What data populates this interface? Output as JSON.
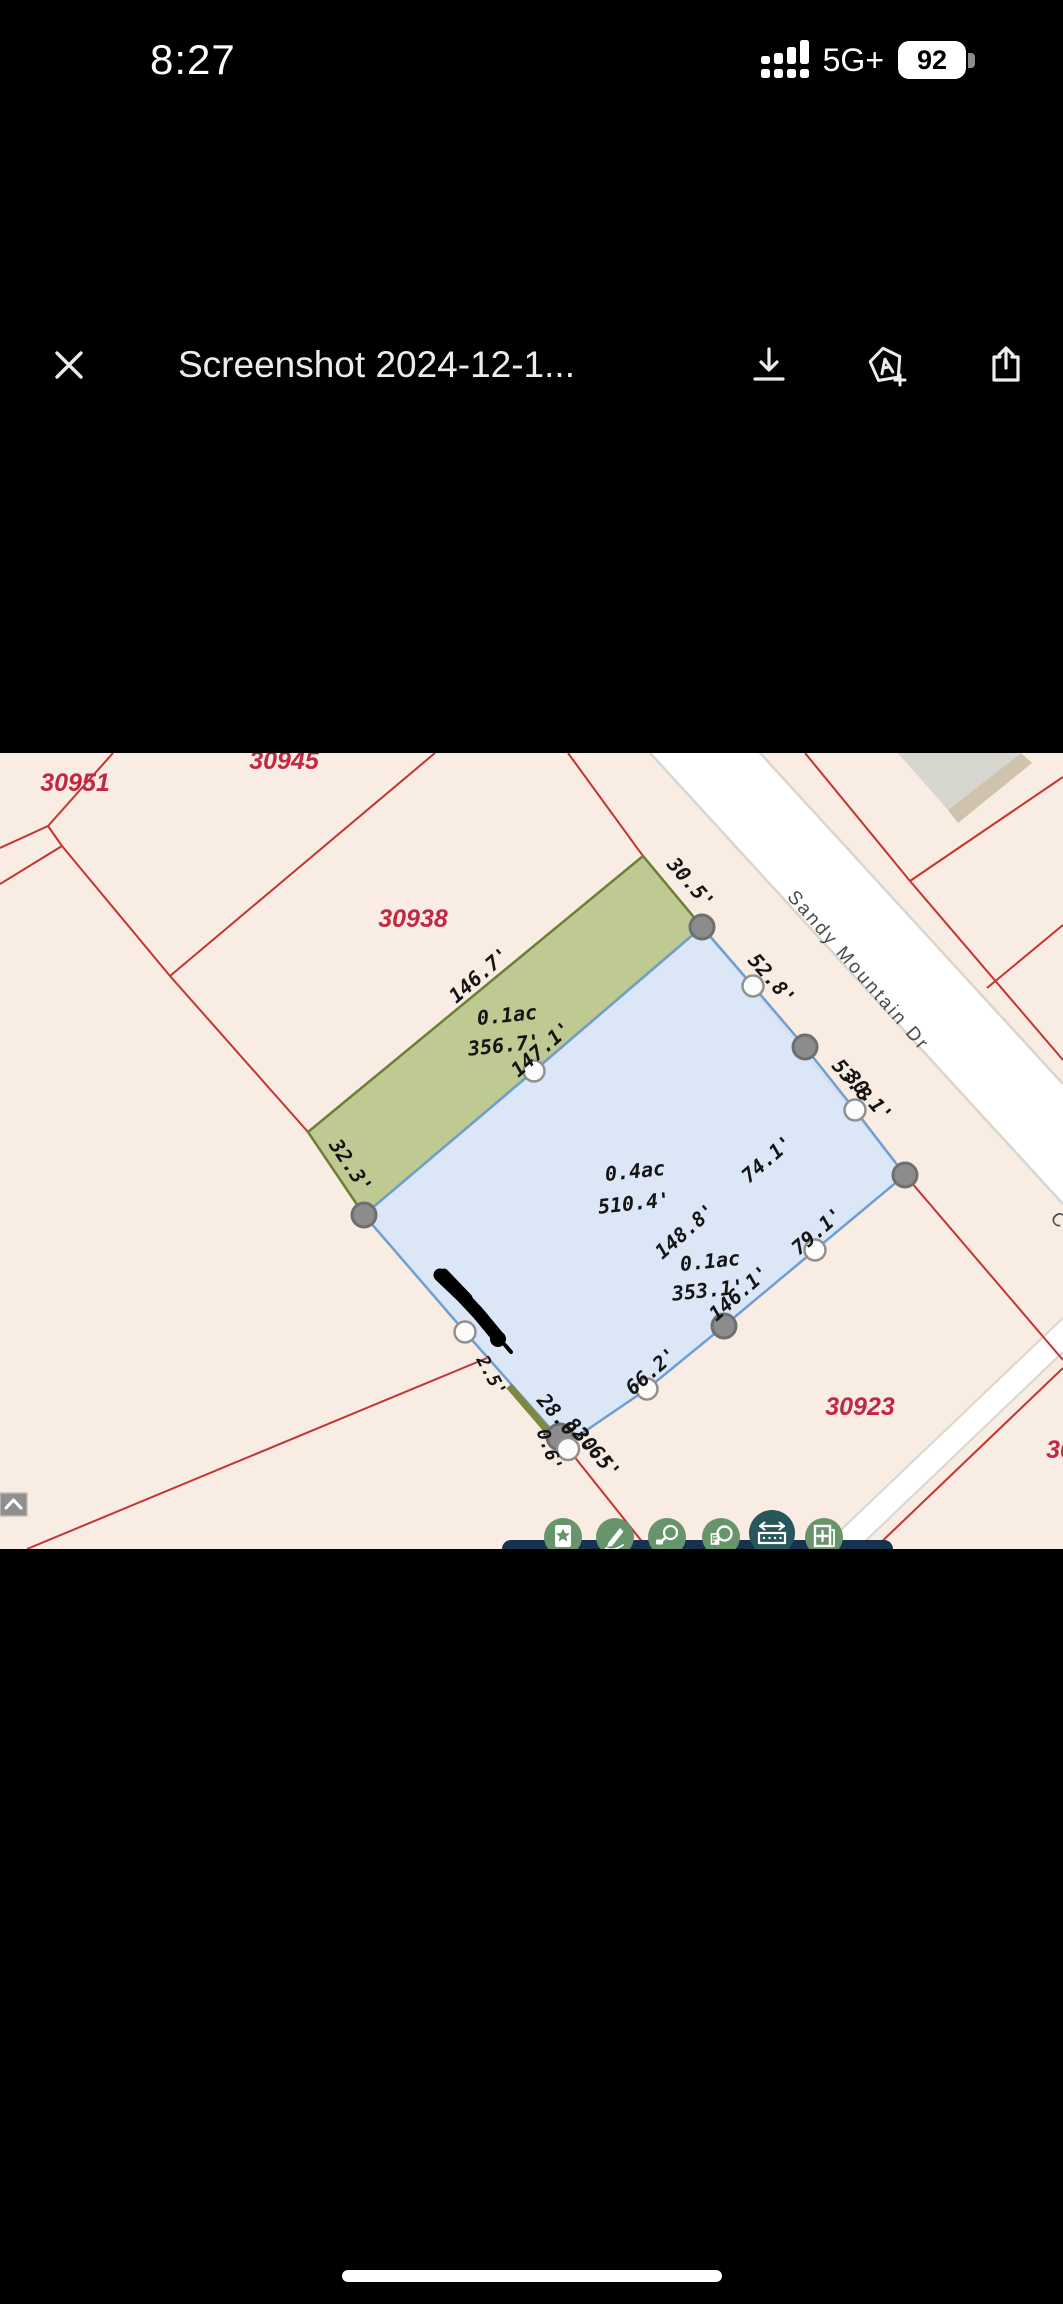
{
  "status_bar": {
    "time": "8:27",
    "network": "5G+",
    "battery_percent": "92"
  },
  "viewer_toolbar": {
    "title": "Screenshot 2024-12-1...",
    "close_label": "close",
    "download_label": "download",
    "add_to_drive_label": "add-to-drive",
    "share_label": "share"
  },
  "map": {
    "colors": {
      "background": "#f8ece3",
      "line_red": "#c53333",
      "parcel_id_red": "#c22743",
      "blue_fill": "#d9e7f8",
      "blue_stroke": "#6f9fd2",
      "green_fill": "#bfca93",
      "olive_stroke": "#6e7e33",
      "road_white": "#ffffff",
      "toolbar_navy": "#17324f",
      "tool_green": "#68946b",
      "tool_selected_teal": "#27565c"
    },
    "street": {
      "name": "Sandy Mountain Dr",
      "partial": "C"
    },
    "parcel_ids": {
      "p30951": "30951",
      "p30945": "30945",
      "p30938": "30938",
      "p30923": "30923",
      "p30_partial": "30"
    },
    "areas": {
      "green_strip": "0.1ac",
      "main_parcel": "0.4ac",
      "inner": "0.1ac"
    },
    "measurements": {
      "m30_5": "30.5'",
      "m52_8": "52.8'",
      "m53_8": "53.8",
      "m30_1": "30.1'",
      "m146_7": "146.7'",
      "m356_7": "356.7'",
      "m147_1": "147.1'",
      "m32_3": "32.3'",
      "m510_4": "510.4'",
      "m74_1": "74.1'",
      "m148_8": "148.8'",
      "m353_1": "353.1'",
      "m146_1": "146.1'",
      "m79_1": "79.1'",
      "m66_2": "66.2'",
      "m2_5": "2.5'",
      "m28_0": "28.0'",
      "m82_6": "82.6'",
      "m30_5b": "30.5'",
      "m0_6": "0.6'"
    }
  }
}
